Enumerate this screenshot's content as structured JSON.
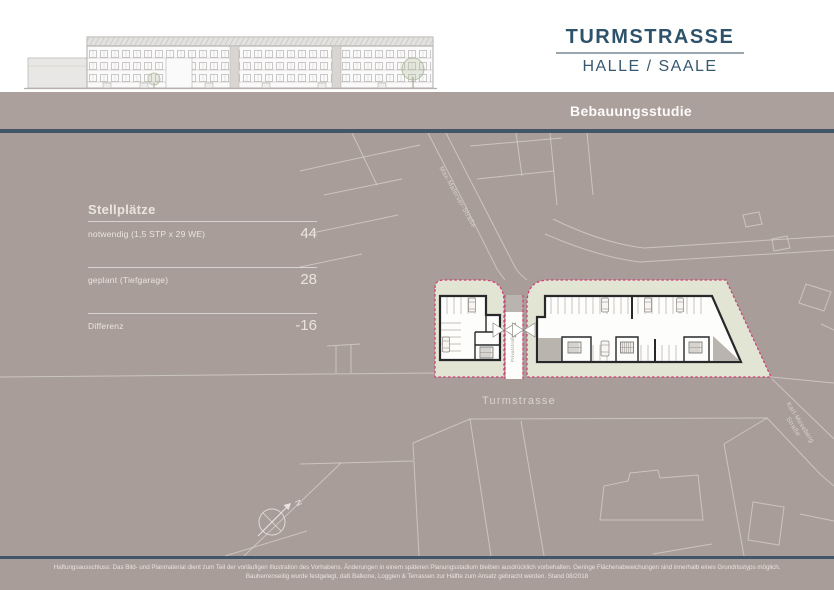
{
  "title": {
    "main": "TURMSTRASSE",
    "sub": "HALLE / SAALE"
  },
  "banner": {
    "label": "Bebauungsstudie"
  },
  "stellplaetze": {
    "heading": "Stellplätze",
    "rows": [
      {
        "label": "notwendig (1,5 STP x 29 WE)",
        "value": "44"
      },
      {
        "label": "geplant (Tiefgarage)",
        "value": "28"
      },
      {
        "label": "Differenz",
        "value": "-16"
      }
    ]
  },
  "plan": {
    "streets": {
      "turmstrasse": "Turmstrasse",
      "max_strasse": "Max-Malerver-Straße",
      "karl_meseberg_line1": "Karl-Meseberg",
      "karl_meseberg_line2": "Straße",
      "driveway": "Privatstraße"
    },
    "compass_label": "N"
  },
  "footer": {
    "line1": "Haftungsausschluss: Das Bild- und Planmaterial dient zum Teil der vorläufigen Illustration des Vorhabens. Änderungen in einem späteren Planungsstadium bleiben ausdrücklich vorbehalten. Geringe Flächenabweichungen sind innerhalb eines Grundrisstyps möglich.",
    "line2": "Bauherrenseitig wurde festgelegt, daß Balkone, Loggien & Terrassen zur Hälfte zum Ansatz gebracht werden. Stand 08/2018"
  },
  "colors": {
    "accent_blue": "#2E526A",
    "rule_dark": "#42566A",
    "background_taupe": "#A99D99",
    "site_green": "#E3E5D4",
    "site_border_pink": "#D23F75"
  }
}
